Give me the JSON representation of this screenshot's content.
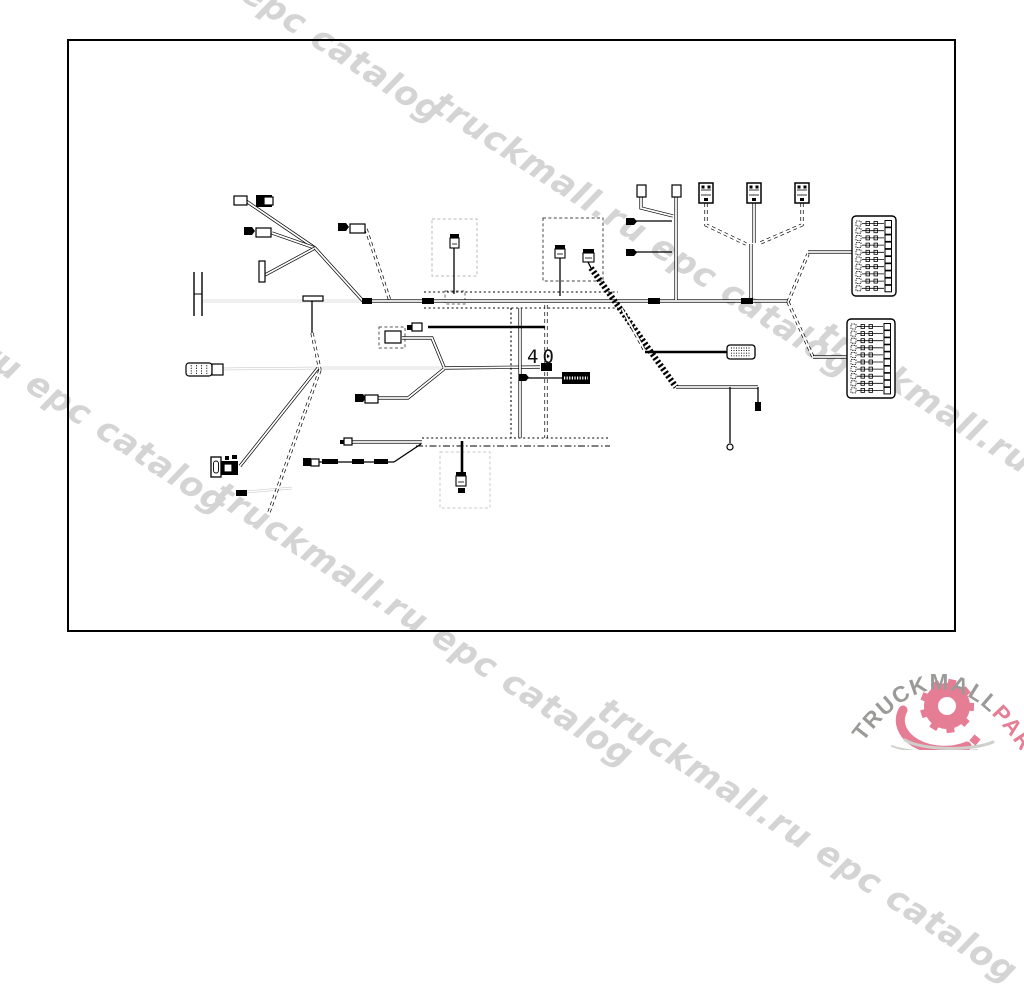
{
  "page": {
    "frame": {
      "x": 68,
      "y": 40,
      "w": 887,
      "h": 591,
      "border_color": "#000000"
    },
    "background": "#ffffff"
  },
  "watermark": {
    "text": "truckmall.ru epc catalog",
    "color": "#d4d4d4",
    "angle_deg": 33,
    "instances": [
      {
        "x": 37,
        "y": -170
      },
      {
        "x": 447,
        "y": 84
      },
      {
        "x": -178,
        "y": 221
      },
      {
        "x": 228,
        "y": 474
      },
      {
        "x": 832,
        "y": 314
      },
      {
        "x": 612,
        "y": 690
      }
    ]
  },
  "logo": {
    "brand": "TRUCKMALL",
    "suffix": "PARTS",
    "brand_color": "#9a9a98",
    "suffix_color": "#e57d95",
    "gear": {
      "cx": 947,
      "cy": 706,
      "r": 23,
      "teeth": 9,
      "hole": 9,
      "color": "#e57d95",
      "shadow": "#cfcfcc"
    }
  },
  "diagram": {
    "label_40": "40",
    "label_40_pos": {
      "x": 527,
      "y": 363
    },
    "part_tag": {
      "x": 562,
      "y": 372,
      "w": 28,
      "h": 12
    },
    "dashed_boxes": [
      {
        "x": 432,
        "y": 219,
        "w": 45,
        "h": 57,
        "c": "#b9b9b9"
      },
      {
        "x": 543,
        "y": 218,
        "w": 60,
        "h": 63,
        "c": "#444444"
      },
      {
        "x": 440,
        "y": 452,
        "w": 50,
        "h": 56,
        "c": "#c9c9c9"
      },
      {
        "x": 379,
        "y": 327,
        "w": 26,
        "h": 21,
        "c": "#555555"
      },
      {
        "x": 445,
        "y": 291,
        "w": 20,
        "h": 13,
        "c": "#666666"
      }
    ],
    "fuse_blocks": [
      {
        "x": 852,
        "y": 216,
        "w": 44,
        "h": 80,
        "rows": 10
      },
      {
        "x": 847,
        "y": 319,
        "w": 48,
        "h": 79,
        "rows": 10
      }
    ],
    "wires": [
      {
        "s": "wl",
        "p": [
          [
            203,
            301
          ],
          [
            361,
            301
          ]
        ]
      },
      {
        "s": "wl",
        "p": [
          [
            222,
            369
          ],
          [
            318,
            368
          ]
        ]
      },
      {
        "s": "wl",
        "p": [
          [
            318,
            368
          ],
          [
            444,
            368
          ]
        ]
      },
      {
        "s": "wl",
        "p": [
          [
            247,
            492
          ],
          [
            292,
            488
          ]
        ]
      },
      {
        "s": "w",
        "p": [
          [
            246,
            201
          ],
          [
            315,
            248
          ]
        ]
      },
      {
        "s": "w",
        "p": [
          [
            272,
            233
          ],
          [
            315,
            248
          ]
        ]
      },
      {
        "s": "w",
        "p": [
          [
            265,
            275
          ],
          [
            315,
            248
          ]
        ]
      },
      {
        "s": "w",
        "p": [
          [
            315,
            248
          ],
          [
            363,
            301
          ]
        ]
      },
      {
        "s": "d",
        "p": [
          [
            366,
            229
          ],
          [
            390,
            301
          ]
        ]
      },
      {
        "s": "k",
        "p": [
          [
            312,
            301
          ],
          [
            312,
            333
          ]
        ]
      },
      {
        "s": "d",
        "p": [
          [
            312,
            333
          ],
          [
            320,
            370
          ]
        ]
      },
      {
        "s": "d",
        "p": [
          [
            320,
            370
          ],
          [
            268,
            515
          ]
        ]
      },
      {
        "s": "w",
        "p": [
          [
            318,
            368
          ],
          [
            240,
            466
          ]
        ]
      },
      {
        "s": "w",
        "p": [
          [
            444,
            368
          ],
          [
            540,
            367
          ]
        ]
      },
      {
        "s": "w",
        "p": [
          [
            402,
            338
          ],
          [
            432,
            338
          ],
          [
            444,
            367
          ]
        ]
      },
      {
        "s": "w",
        "p": [
          [
            373,
            398
          ],
          [
            408,
            398
          ],
          [
            444,
            369
          ]
        ]
      },
      {
        "s": "w",
        "p": [
          [
            363,
            301
          ],
          [
            788,
            301
          ]
        ]
      },
      {
        "s": "dot",
        "p": [
          [
            424,
            292
          ],
          [
            618,
            292
          ]
        ]
      },
      {
        "s": "dot",
        "p": [
          [
            424,
            308
          ],
          [
            618,
            308
          ]
        ]
      },
      {
        "s": "dot",
        "p": [
          [
            511,
            308
          ],
          [
            511,
            438
          ]
        ]
      },
      {
        "s": "w",
        "p": [
          [
            520,
            308
          ],
          [
            520,
            438
          ]
        ]
      },
      {
        "s": "d",
        "p": [
          [
            546,
            305
          ],
          [
            546,
            363
          ]
        ]
      },
      {
        "s": "d",
        "p": [
          [
            546,
            372
          ],
          [
            546,
            438
          ]
        ]
      },
      {
        "s": "kk",
        "p": [
          [
            428,
            327
          ],
          [
            545,
            327
          ]
        ]
      },
      {
        "s": "k",
        "p": [
          [
            454,
            248
          ],
          [
            454,
            294
          ]
        ]
      },
      {
        "s": "k",
        "p": [
          [
            560,
            258
          ],
          [
            560,
            296
          ]
        ]
      },
      {
        "s": "k",
        "p": [
          [
            588,
            262
          ],
          [
            591,
            268
          ]
        ]
      },
      {
        "s": "h",
        "p": [
          [
            591,
            268
          ],
          [
            676,
            387
          ]
        ]
      },
      {
        "s": "w",
        "p": [
          [
            676,
            387
          ],
          [
            758,
            387
          ]
        ]
      },
      {
        "s": "k",
        "p": [
          [
            758,
            387
          ],
          [
            758,
            403
          ]
        ]
      },
      {
        "s": "k",
        "p": [
          [
            730,
            387
          ],
          [
            730,
            443
          ]
        ]
      },
      {
        "s": "d",
        "p": [
          [
            622,
            309
          ],
          [
            645,
            351
          ]
        ]
      },
      {
        "s": "kk",
        "p": [
          [
            645,
            352
          ],
          [
            727,
            352
          ]
        ]
      },
      {
        "s": "w",
        "p": [
          [
            641,
            197
          ],
          [
            641,
            208
          ],
          [
            673,
            216
          ]
        ]
      },
      {
        "s": "w",
        "p": [
          [
            676,
            197
          ],
          [
            676,
            300
          ]
        ]
      },
      {
        "s": "k",
        "p": [
          [
            634,
            221
          ],
          [
            672,
            221
          ]
        ]
      },
      {
        "s": "k",
        "p": [
          [
            634,
            252
          ],
          [
            672,
            252
          ]
        ]
      },
      {
        "s": "d",
        "p": [
          [
            706,
            203
          ],
          [
            706,
            225
          ],
          [
            746,
            244
          ]
        ]
      },
      {
        "s": "w",
        "p": [
          [
            754,
            203
          ],
          [
            754,
            243
          ]
        ]
      },
      {
        "s": "d",
        "p": [
          [
            802,
            203
          ],
          [
            802,
            225
          ],
          [
            758,
            244
          ]
        ]
      },
      {
        "s": "w",
        "p": [
          [
            751,
            244
          ],
          [
            751,
            300
          ]
        ]
      },
      {
        "s": "d",
        "p": [
          [
            788,
            302
          ],
          [
            808,
            254
          ]
        ]
      },
      {
        "s": "w",
        "p": [
          [
            808,
            252
          ],
          [
            852,
            252
          ]
        ]
      },
      {
        "s": "d",
        "p": [
          [
            788,
            302
          ],
          [
            813,
            357
          ]
        ]
      },
      {
        "s": "w",
        "p": [
          [
            813,
            357
          ],
          [
            848,
            357
          ]
        ]
      },
      {
        "s": "w",
        "p": [
          [
            350,
            442
          ],
          [
            422,
            442
          ]
        ]
      },
      {
        "s": "dot",
        "p": [
          [
            422,
            438
          ],
          [
            610,
            438
          ]
        ]
      },
      {
        "s": "dashdot",
        "p": [
          [
            416,
            446
          ],
          [
            610,
            446
          ]
        ]
      },
      {
        "s": "k",
        "p": [
          [
            316,
            462
          ],
          [
            394,
            462
          ]
        ]
      },
      {
        "s": "k",
        "p": [
          [
            394,
            462
          ],
          [
            421,
            444
          ]
        ]
      },
      {
        "s": "kk",
        "p": [
          [
            462,
            441
          ],
          [
            462,
            473
          ]
        ]
      },
      {
        "s": "k",
        "p": [
          [
            527,
            378
          ],
          [
            562,
            378
          ]
        ]
      }
    ],
    "connectors": [
      {
        "t": "o",
        "x": 234,
        "y": 196,
        "w": 13,
        "h": 9
      },
      {
        "t": "f",
        "x": 256,
        "y": 195,
        "w": 16,
        "h": 12
      },
      {
        "t": "o",
        "x": 264,
        "y": 197,
        "w": 9,
        "h": 8
      },
      {
        "t": "flag",
        "x": 244,
        "y": 227,
        "w": 8,
        "h": 8
      },
      {
        "t": "o",
        "x": 256,
        "y": 228,
        "w": 15,
        "h": 9
      },
      {
        "t": "flag",
        "x": 338,
        "y": 223,
        "w": 8,
        "h": 8
      },
      {
        "t": "o",
        "x": 350,
        "y": 224,
        "w": 15,
        "h": 9
      },
      {
        "t": "o",
        "x": 259,
        "y": 261,
        "w": 6,
        "h": 21
      },
      {
        "t": "vbar",
        "x": 194,
        "y": 272,
        "w": 8,
        "h": 44
      },
      {
        "t": "o",
        "x": 303,
        "y": 296,
        "w": 20,
        "h": 5
      },
      {
        "t": "barrel",
        "x": 186,
        "y": 363,
        "w": 26,
        "h": 13
      },
      {
        "t": "o",
        "x": 212,
        "y": 364,
        "w": 11,
        "h": 11
      },
      {
        "t": "o",
        "x": 385,
        "y": 331,
        "w": 16,
        "h": 12
      },
      {
        "t": "flag",
        "x": 355,
        "y": 394,
        "w": 8,
        "h": 8
      },
      {
        "t": "o",
        "x": 365,
        "y": 395,
        "w": 13,
        "h": 8
      },
      {
        "t": "capc",
        "x": 450,
        "y": 234,
        "w": 9,
        "h": 14
      },
      {
        "t": "capc",
        "x": 555,
        "y": 245,
        "w": 10,
        "h": 13
      },
      {
        "t": "capc",
        "x": 583,
        "y": 249,
        "w": 11,
        "h": 13
      },
      {
        "t": "ecu",
        "x": 699,
        "y": 183,
        "w": 14,
        "h": 20
      },
      {
        "t": "ecu",
        "x": 747,
        "y": 183,
        "w": 14,
        "h": 20
      },
      {
        "t": "ecu",
        "x": 795,
        "y": 183,
        "w": 14,
        "h": 20
      },
      {
        "t": "o",
        "x": 637,
        "y": 185,
        "w": 9,
        "h": 12
      },
      {
        "t": "o",
        "x": 672,
        "y": 185,
        "w": 9,
        "h": 12
      },
      {
        "t": "flag",
        "x": 626,
        "y": 218,
        "w": 8,
        "h": 7
      },
      {
        "t": "flag",
        "x": 626,
        "y": 249,
        "w": 8,
        "h": 7
      },
      {
        "t": "striped",
        "x": 727,
        "y": 345,
        "w": 28,
        "h": 14
      },
      {
        "t": "o",
        "x": 412,
        "y": 323,
        "w": 10,
        "h": 8
      },
      {
        "t": "f",
        "x": 407,
        "y": 325,
        "w": 5,
        "h": 5
      },
      {
        "t": "f",
        "x": 755,
        "y": 402,
        "w": 6,
        "h": 9
      },
      {
        "t": "circle",
        "x": 730,
        "y": 447,
        "r": 3
      },
      {
        "t": "o",
        "x": 344,
        "y": 438,
        "w": 8,
        "h": 7
      },
      {
        "t": "f",
        "x": 340,
        "y": 440,
        "w": 4,
        "h": 4
      },
      {
        "t": "f",
        "x": 303,
        "y": 458,
        "w": 8,
        "h": 8
      },
      {
        "t": "o",
        "x": 311,
        "y": 459,
        "w": 8,
        "h": 7
      },
      {
        "t": "f",
        "x": 322,
        "y": 459,
        "w": 16,
        "h": 5
      },
      {
        "t": "f",
        "x": 352,
        "y": 459,
        "w": 12,
        "h": 5
      },
      {
        "t": "f",
        "x": 374,
        "y": 459,
        "w": 14,
        "h": 5
      },
      {
        "t": "capc",
        "x": 456,
        "y": 472,
        "w": 10,
        "h": 14
      },
      {
        "t": "f",
        "x": 458,
        "y": 488,
        "w": 7,
        "h": 5
      },
      {
        "t": "slot",
        "x": 211,
        "y": 457,
        "w": 10,
        "h": 20
      },
      {
        "t": "f",
        "x": 221,
        "y": 461,
        "w": 17,
        "h": 14
      },
      {
        "t": "o",
        "x": 224,
        "y": 464,
        "w": 8,
        "h": 8
      },
      {
        "t": "f",
        "x": 225,
        "y": 456,
        "w": 4,
        "h": 4
      },
      {
        "t": "f",
        "x": 232,
        "y": 455,
        "w": 5,
        "h": 4
      },
      {
        "t": "f",
        "x": 236,
        "y": 490,
        "w": 11,
        "h": 6
      },
      {
        "t": "f",
        "x": 362,
        "y": 298,
        "w": 10,
        "h": 6
      },
      {
        "t": "f",
        "x": 422,
        "y": 298,
        "w": 12,
        "h": 6
      },
      {
        "t": "f",
        "x": 648,
        "y": 298,
        "w": 12,
        "h": 6
      },
      {
        "t": "f",
        "x": 741,
        "y": 298,
        "w": 12,
        "h": 6
      },
      {
        "t": "f",
        "x": 541,
        "y": 363,
        "w": 11,
        "h": 8
      },
      {
        "t": "flag",
        "x": 519,
        "y": 374,
        "w": 7,
        "h": 7
      }
    ]
  }
}
